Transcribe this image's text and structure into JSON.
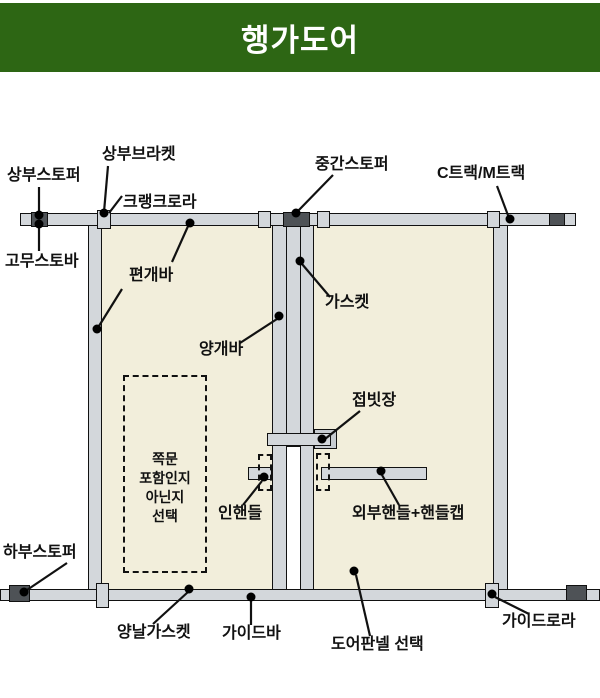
{
  "header": {
    "title": "행가도어"
  },
  "colors": {
    "header_bg": "#2d6614",
    "header_text": "#ffffff",
    "door_panel": "#f2eedb",
    "bar_gray": "#d3d7db",
    "stopper_dark": "#4e5256",
    "line_color": "#111111"
  },
  "labels": {
    "top_stopper": "상부스토퍼",
    "top_bracket": "상부브라켓",
    "crank_roller": "크랭크로라",
    "middle_stopper": "중간스토퍼",
    "track": "C트랙/M트랙",
    "rubber_stopper": "고무스토바",
    "single_leaf_bar": "편개바",
    "gasket": "가스켓",
    "double_leaf_bar": "양개바",
    "folding_latch": "접빗장",
    "inner_handle": "인핸들",
    "outer_handle": "외부핸들+핸들캡",
    "bottom_stopper": "하부스토퍼",
    "double_edge_gasket": "양날가스켓",
    "guide_bar": "가이드바",
    "door_panel_select": "도어판넬 선택",
    "guide_roller": "가이드로라"
  },
  "side_door_note": {
    "lines": [
      "쪽문",
      "포함인지",
      "아닌지",
      "선택"
    ]
  }
}
